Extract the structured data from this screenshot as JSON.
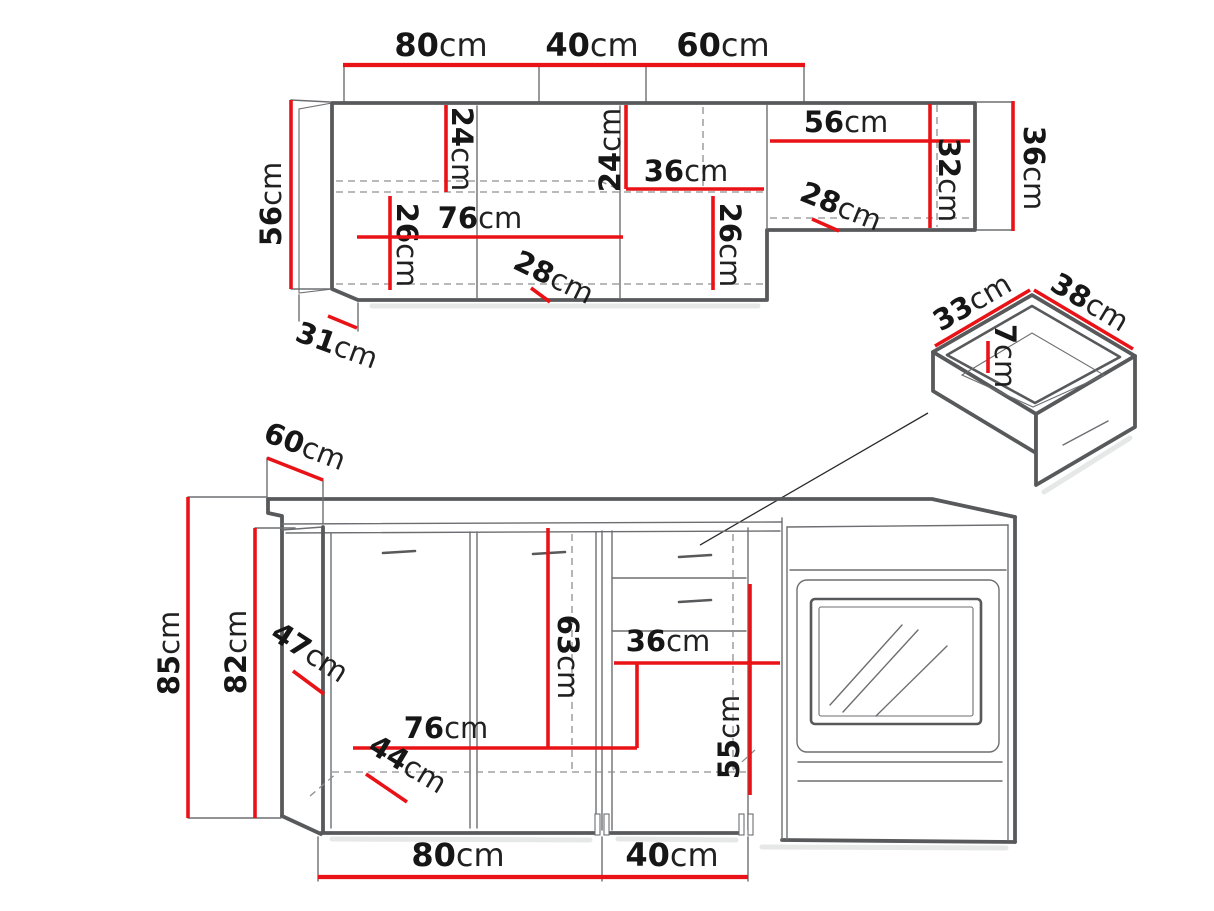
{
  "meta": {
    "description": "Kitchen cabinet set dimension diagram",
    "unit": "cm"
  },
  "colors": {
    "red": "#e91317",
    "outline": "#58595b",
    "thinline": "#6d6e71",
    "dashline": "#8f8f8f",
    "ink": "#161616"
  },
  "dims": {
    "top_w80": {
      "v": "80",
      "u": "cm"
    },
    "top_w40": {
      "v": "40",
      "u": "cm"
    },
    "top_w60": {
      "v": "60",
      "u": "cm"
    },
    "up_h56": {
      "v": "56",
      "u": "cm"
    },
    "up_24a": {
      "v": "24",
      "u": "cm"
    },
    "up_24b": {
      "v": "24",
      "u": "cm"
    },
    "up_36mid": {
      "v": "36",
      "u": "cm"
    },
    "up_56wide": {
      "v": "56",
      "u": "cm"
    },
    "up_32": {
      "v": "32",
      "u": "cm"
    },
    "up_36right": {
      "v": "36",
      "u": "cm"
    },
    "up_26a": {
      "v": "26",
      "u": "cm"
    },
    "up_76": {
      "v": "76",
      "u": "cm"
    },
    "up_26b": {
      "v": "26",
      "u": "cm"
    },
    "up_28a": {
      "v": "28",
      "u": "cm"
    },
    "up_28b": {
      "v": "28",
      "u": "cm"
    },
    "up_31": {
      "v": "31",
      "u": "cm"
    },
    "dr_33": {
      "v": "33",
      "u": "cm"
    },
    "dr_38": {
      "v": "38",
      "u": "cm"
    },
    "dr_7": {
      "v": "7",
      "u": "cm"
    },
    "low_60": {
      "v": "60",
      "u": "cm"
    },
    "low_85": {
      "v": "85",
      "u": "cm"
    },
    "low_82": {
      "v": "82",
      "u": "cm"
    },
    "low_47": {
      "v": "47",
      "u": "cm"
    },
    "low_63": {
      "v": "63",
      "u": "cm"
    },
    "low_36": {
      "v": "36",
      "u": "cm"
    },
    "low_76": {
      "v": "76",
      "u": "cm"
    },
    "low_55": {
      "v": "55",
      "u": "cm"
    },
    "low_44": {
      "v": "44",
      "u": "cm"
    },
    "bot_w80": {
      "v": "80",
      "u": "cm"
    },
    "bot_w40": {
      "v": "40",
      "u": "cm"
    }
  }
}
